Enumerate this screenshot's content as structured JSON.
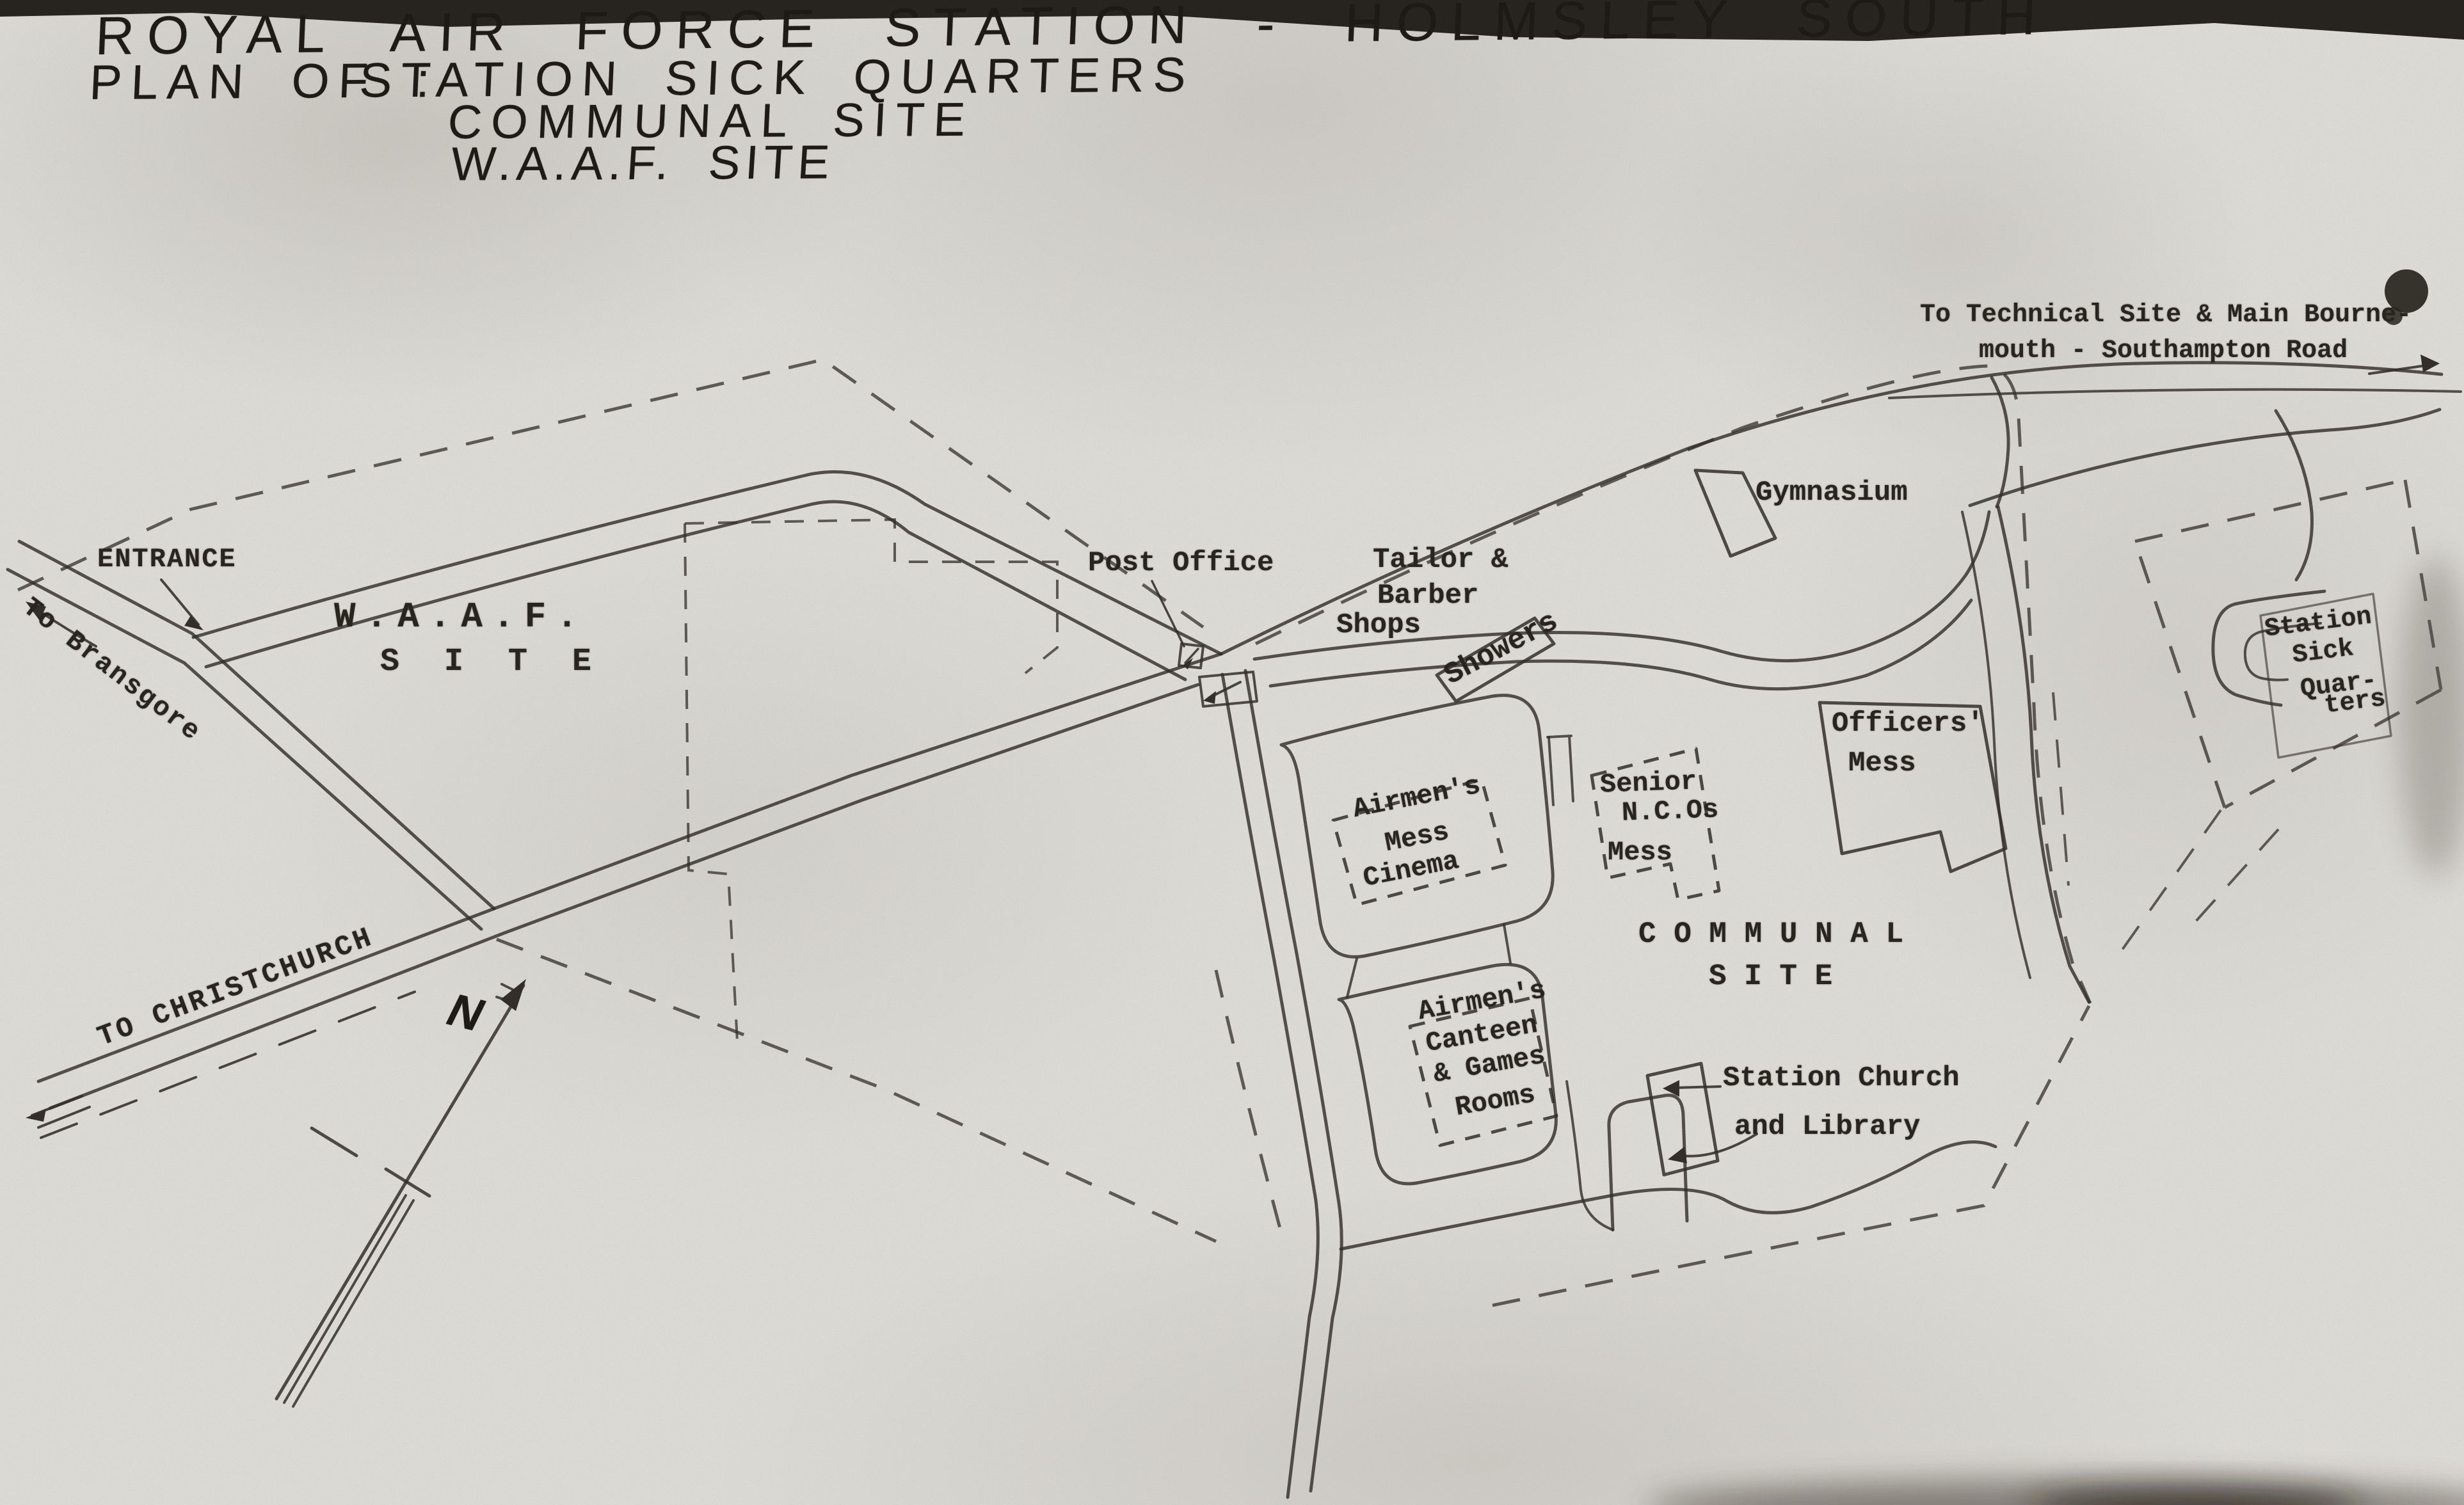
{
  "title": {
    "line1": "ROYAL AIR FORCE STATION - HOLMSLEY SOUTH",
    "plan_of": "PLAN OF :",
    "subjects": [
      "STATION SICK QUARTERS",
      "COMMUNAL SITE",
      "W.A.A.F. SITE"
    ]
  },
  "roads": {
    "to_technical_line1": "To Technical Site & Main Bourne-",
    "to_technical_line2": "mouth - Southampton Road",
    "entrance": "ENTRANCE",
    "to_bransgore": "To Bransgore",
    "to_christchurch": "TO CHRISTCHURCH"
  },
  "waaf_site": {
    "line1": "W.A.A.F.",
    "line2": "S I T E"
  },
  "communal_site": {
    "line1": "C O M M U N A L",
    "line2": "S I T E",
    "post_office": "Post Office",
    "tailor_barber": [
      "Tailor &",
      "Barber",
      "Shops"
    ],
    "showers": "Showers",
    "gymnasium": "Gymnasium",
    "officers_mess": [
      "Officers'",
      "Mess"
    ],
    "senior_ncos_mess": [
      "Senior",
      "N.C.Os",
      "Mess"
    ],
    "airmens_mess": [
      "Airmen's",
      "Mess"
    ],
    "cinema": "Cinema",
    "airmens_canteen": [
      "Airmen's",
      "Canteen",
      "& Games",
      "Rooms"
    ],
    "church_library": [
      "Station Church",
      "and Library"
    ]
  },
  "sick_quarters": {
    "label": [
      "Station",
      "Sick",
      "Quar-",
      "ters"
    ]
  },
  "compass": {
    "north_letter": "N"
  },
  "colors": {
    "paper": "#e9e7e2",
    "ink": "#2e2924"
  }
}
